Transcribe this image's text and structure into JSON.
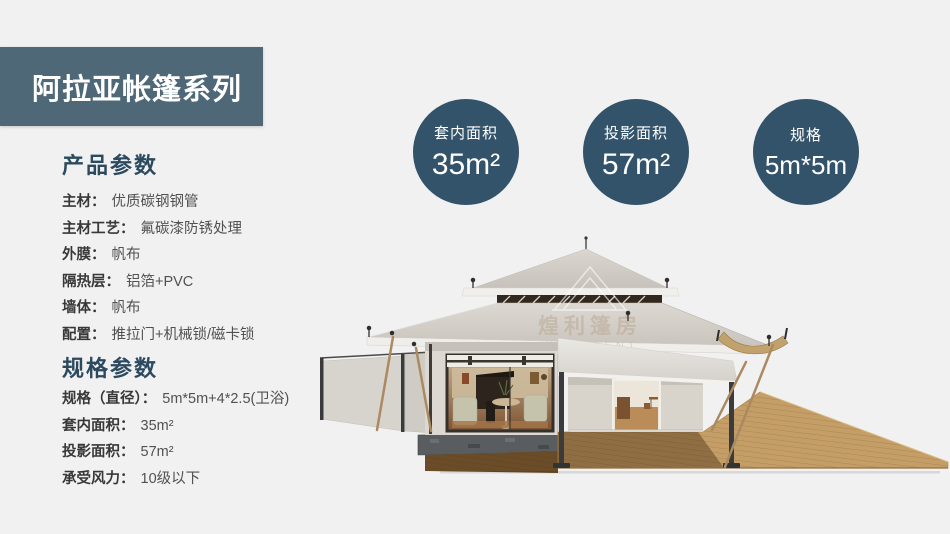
{
  "banner": {
    "title": "阿拉亚帐篷系列"
  },
  "badges": [
    {
      "label": "套内面积",
      "value": "35m²"
    },
    {
      "label": "投影面积",
      "value": "57m²"
    },
    {
      "label": "规格",
      "value": "5m*5m"
    }
  ],
  "sections": [
    {
      "heading": "产品参数",
      "rows": [
        {
          "label": "主材：",
          "value": "优质碳钢钢管"
        },
        {
          "label": "主材工艺：",
          "value": "氟碳漆防锈处理"
        },
        {
          "label": "外膜：",
          "value": "帆布"
        },
        {
          "label": "隔热层：",
          "value": "铝箔+PVC"
        },
        {
          "label": "墙体：",
          "value": "帆布"
        },
        {
          "label": "配置：",
          "value": "推拉门+机械锁/磁卡锁"
        }
      ]
    },
    {
      "heading": "规格参数",
      "rows": [
        {
          "label": "规格（直径）：",
          "value": "5m*5m+4*2.5(卫浴)"
        },
        {
          "label": "套内面积：",
          "value": "35m²"
        },
        {
          "label": "投影面积：",
          "value": "57m²"
        },
        {
          "label": "承受风力：",
          "value": "10级以下"
        }
      ]
    }
  ],
  "watermark": {
    "cn": "煌利篷房",
    "en": "WELL TENT"
  },
  "colors": {
    "page_background": "#f1f1f2",
    "banner_background": "#4e6878",
    "badge_background": "#33536a",
    "heading_text": "#2c4a5f",
    "label_text": "#383838",
    "value_text": "#515151"
  }
}
